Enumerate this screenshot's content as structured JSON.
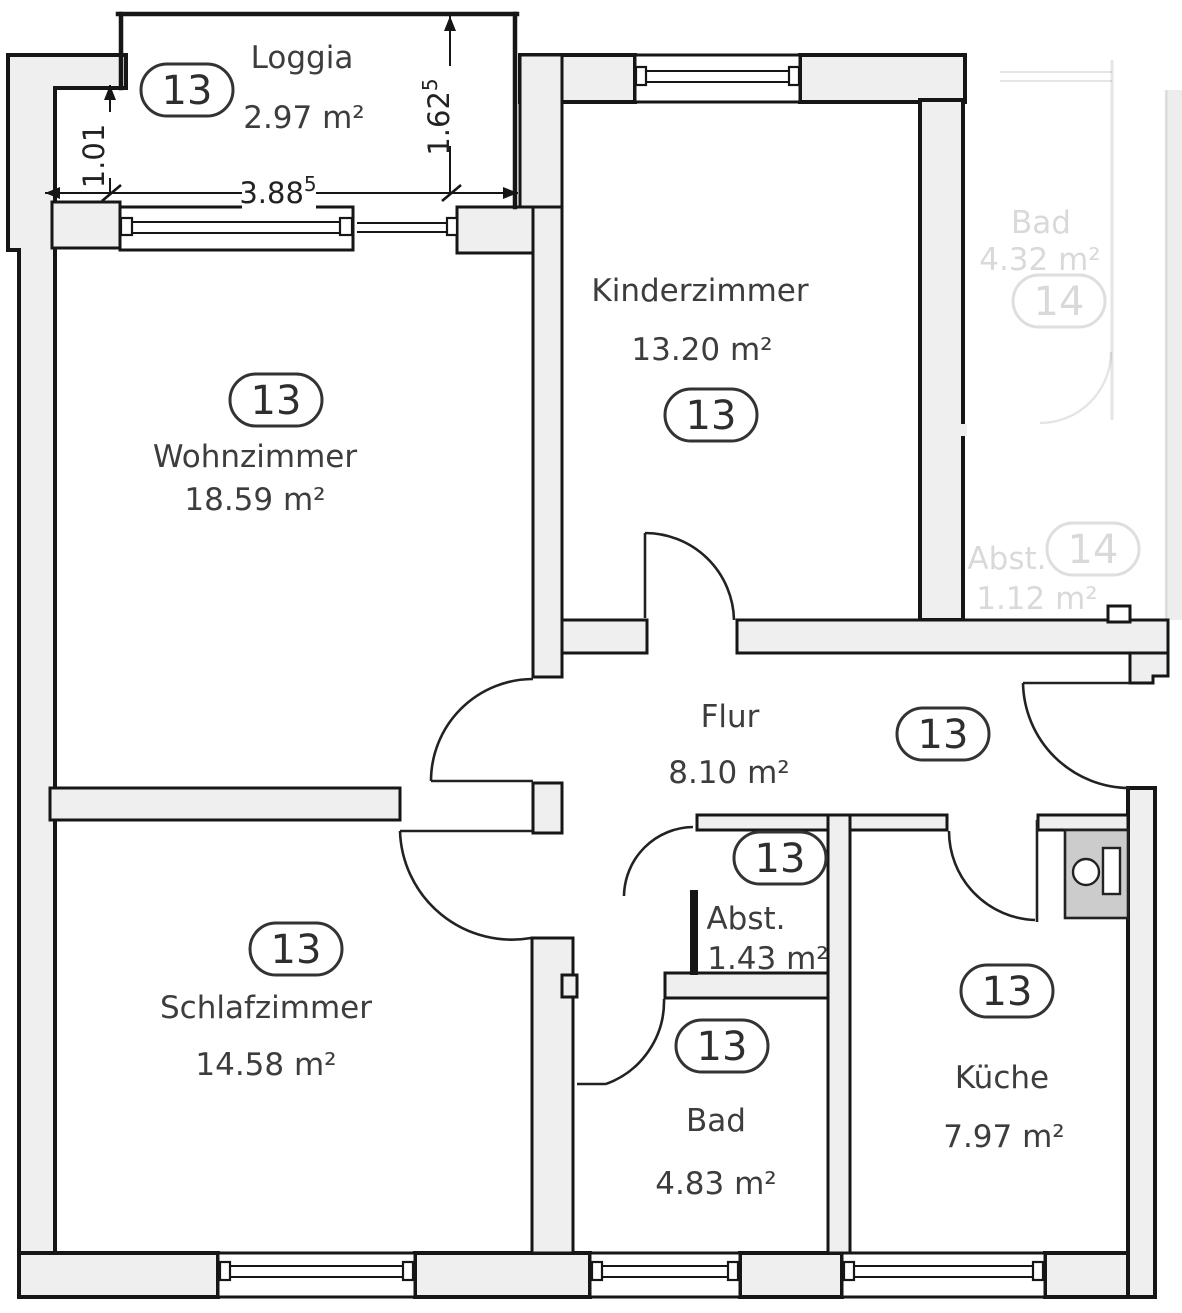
{
  "plan": {
    "apartment_number": "13",
    "rooms": [
      {
        "id": "loggia",
        "name": "Loggia",
        "area": "2.97 m²",
        "badge": "13"
      },
      {
        "id": "wohnzimmer",
        "name": "Wohnzimmer",
        "area": "18.59 m²",
        "badge": "13"
      },
      {
        "id": "kinderzimmer",
        "name": "Kinderzimmer",
        "area": "13.20 m²",
        "badge": "13"
      },
      {
        "id": "flur",
        "name": "Flur",
        "area": "8.10 m²",
        "badge": "13"
      },
      {
        "id": "schlafzimmer",
        "name": "Schlafzimmer",
        "area": "14.58 m²",
        "badge": "13"
      },
      {
        "id": "abstellraum",
        "name": "Abst.",
        "area": "1.43 m²",
        "badge": "13"
      },
      {
        "id": "bad",
        "name": "Bad",
        "area": "4.83 m²",
        "badge": "13"
      },
      {
        "id": "kueche",
        "name": "Küche",
        "area": "7.97 m²",
        "badge": "13"
      }
    ],
    "neighbor_rooms": [
      {
        "id": "neighbor-bad",
        "name": "Bad",
        "area": "4.32 m²",
        "badge": "14"
      },
      {
        "id": "neighbor-abstellraum",
        "name": "Abst.",
        "area": "1.12 m²",
        "badge": "14"
      }
    ],
    "dimensions": [
      {
        "id": "dim-loggia-width",
        "value": "3.88",
        "superscript": "5"
      },
      {
        "id": "dim-loggia-left-depth",
        "value": "1.01",
        "superscript": ""
      },
      {
        "id": "dim-loggia-right-depth",
        "value": "1.62",
        "superscript": "5"
      }
    ],
    "colors": {
      "wall_fill": "#efefef",
      "wall_line": "#161616",
      "text": "#3d3d3d",
      "fixture_fill": "#cccccc"
    }
  }
}
